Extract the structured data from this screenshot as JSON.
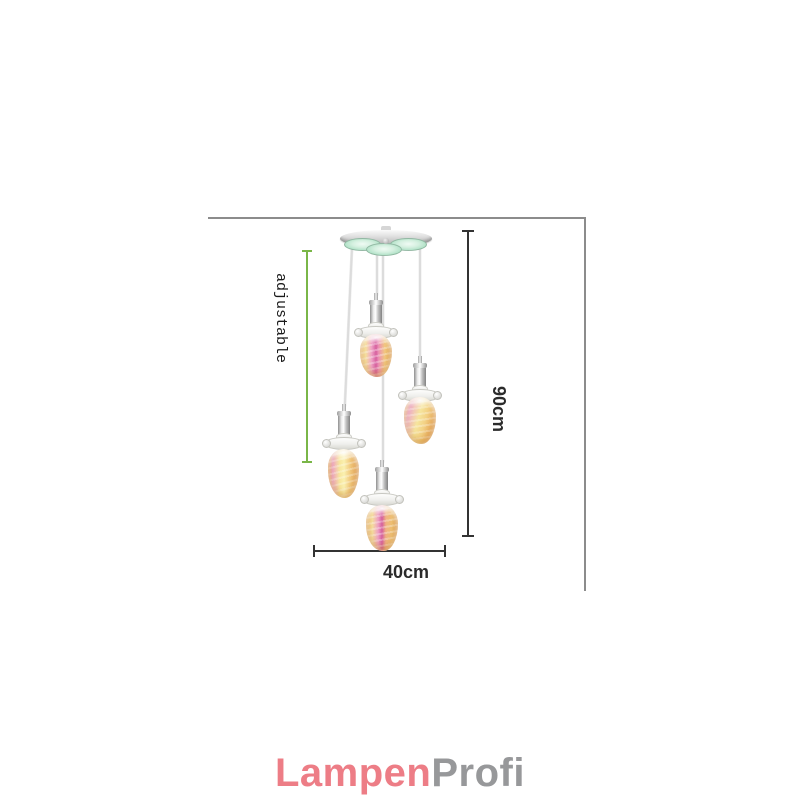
{
  "canvas": {
    "width": 800,
    "height": 800,
    "background": "#ffffff"
  },
  "annotations": {
    "adjustable": {
      "label": "adjustable",
      "line_color": "#7ab648",
      "text_color": "#1a1a1a"
    },
    "height": {
      "label": "90cm",
      "line_color": "#333333",
      "text_color": "#2b2b2b"
    },
    "width": {
      "label": "40cm",
      "line_color": "#333333",
      "text_color": "#2b2b2b"
    },
    "frame_color": "#8c8c8c"
  },
  "product": {
    "description": "crystal pendant ceiling lamp with four hanging shades",
    "pendant_count": 4,
    "colors": {
      "chrome": "#c6c6c6",
      "canopy_glass_green": "#b2e2c8",
      "shade_pink": "#d6609f",
      "shade_amber": "#e2a152",
      "shade_yellow": "#f7e79c",
      "cord": "#dcdcdc"
    }
  },
  "logo": {
    "part1": "Lampen",
    "part2": "Profi",
    "part1_color": "#ed7d86",
    "part2_color": "#97989a"
  }
}
